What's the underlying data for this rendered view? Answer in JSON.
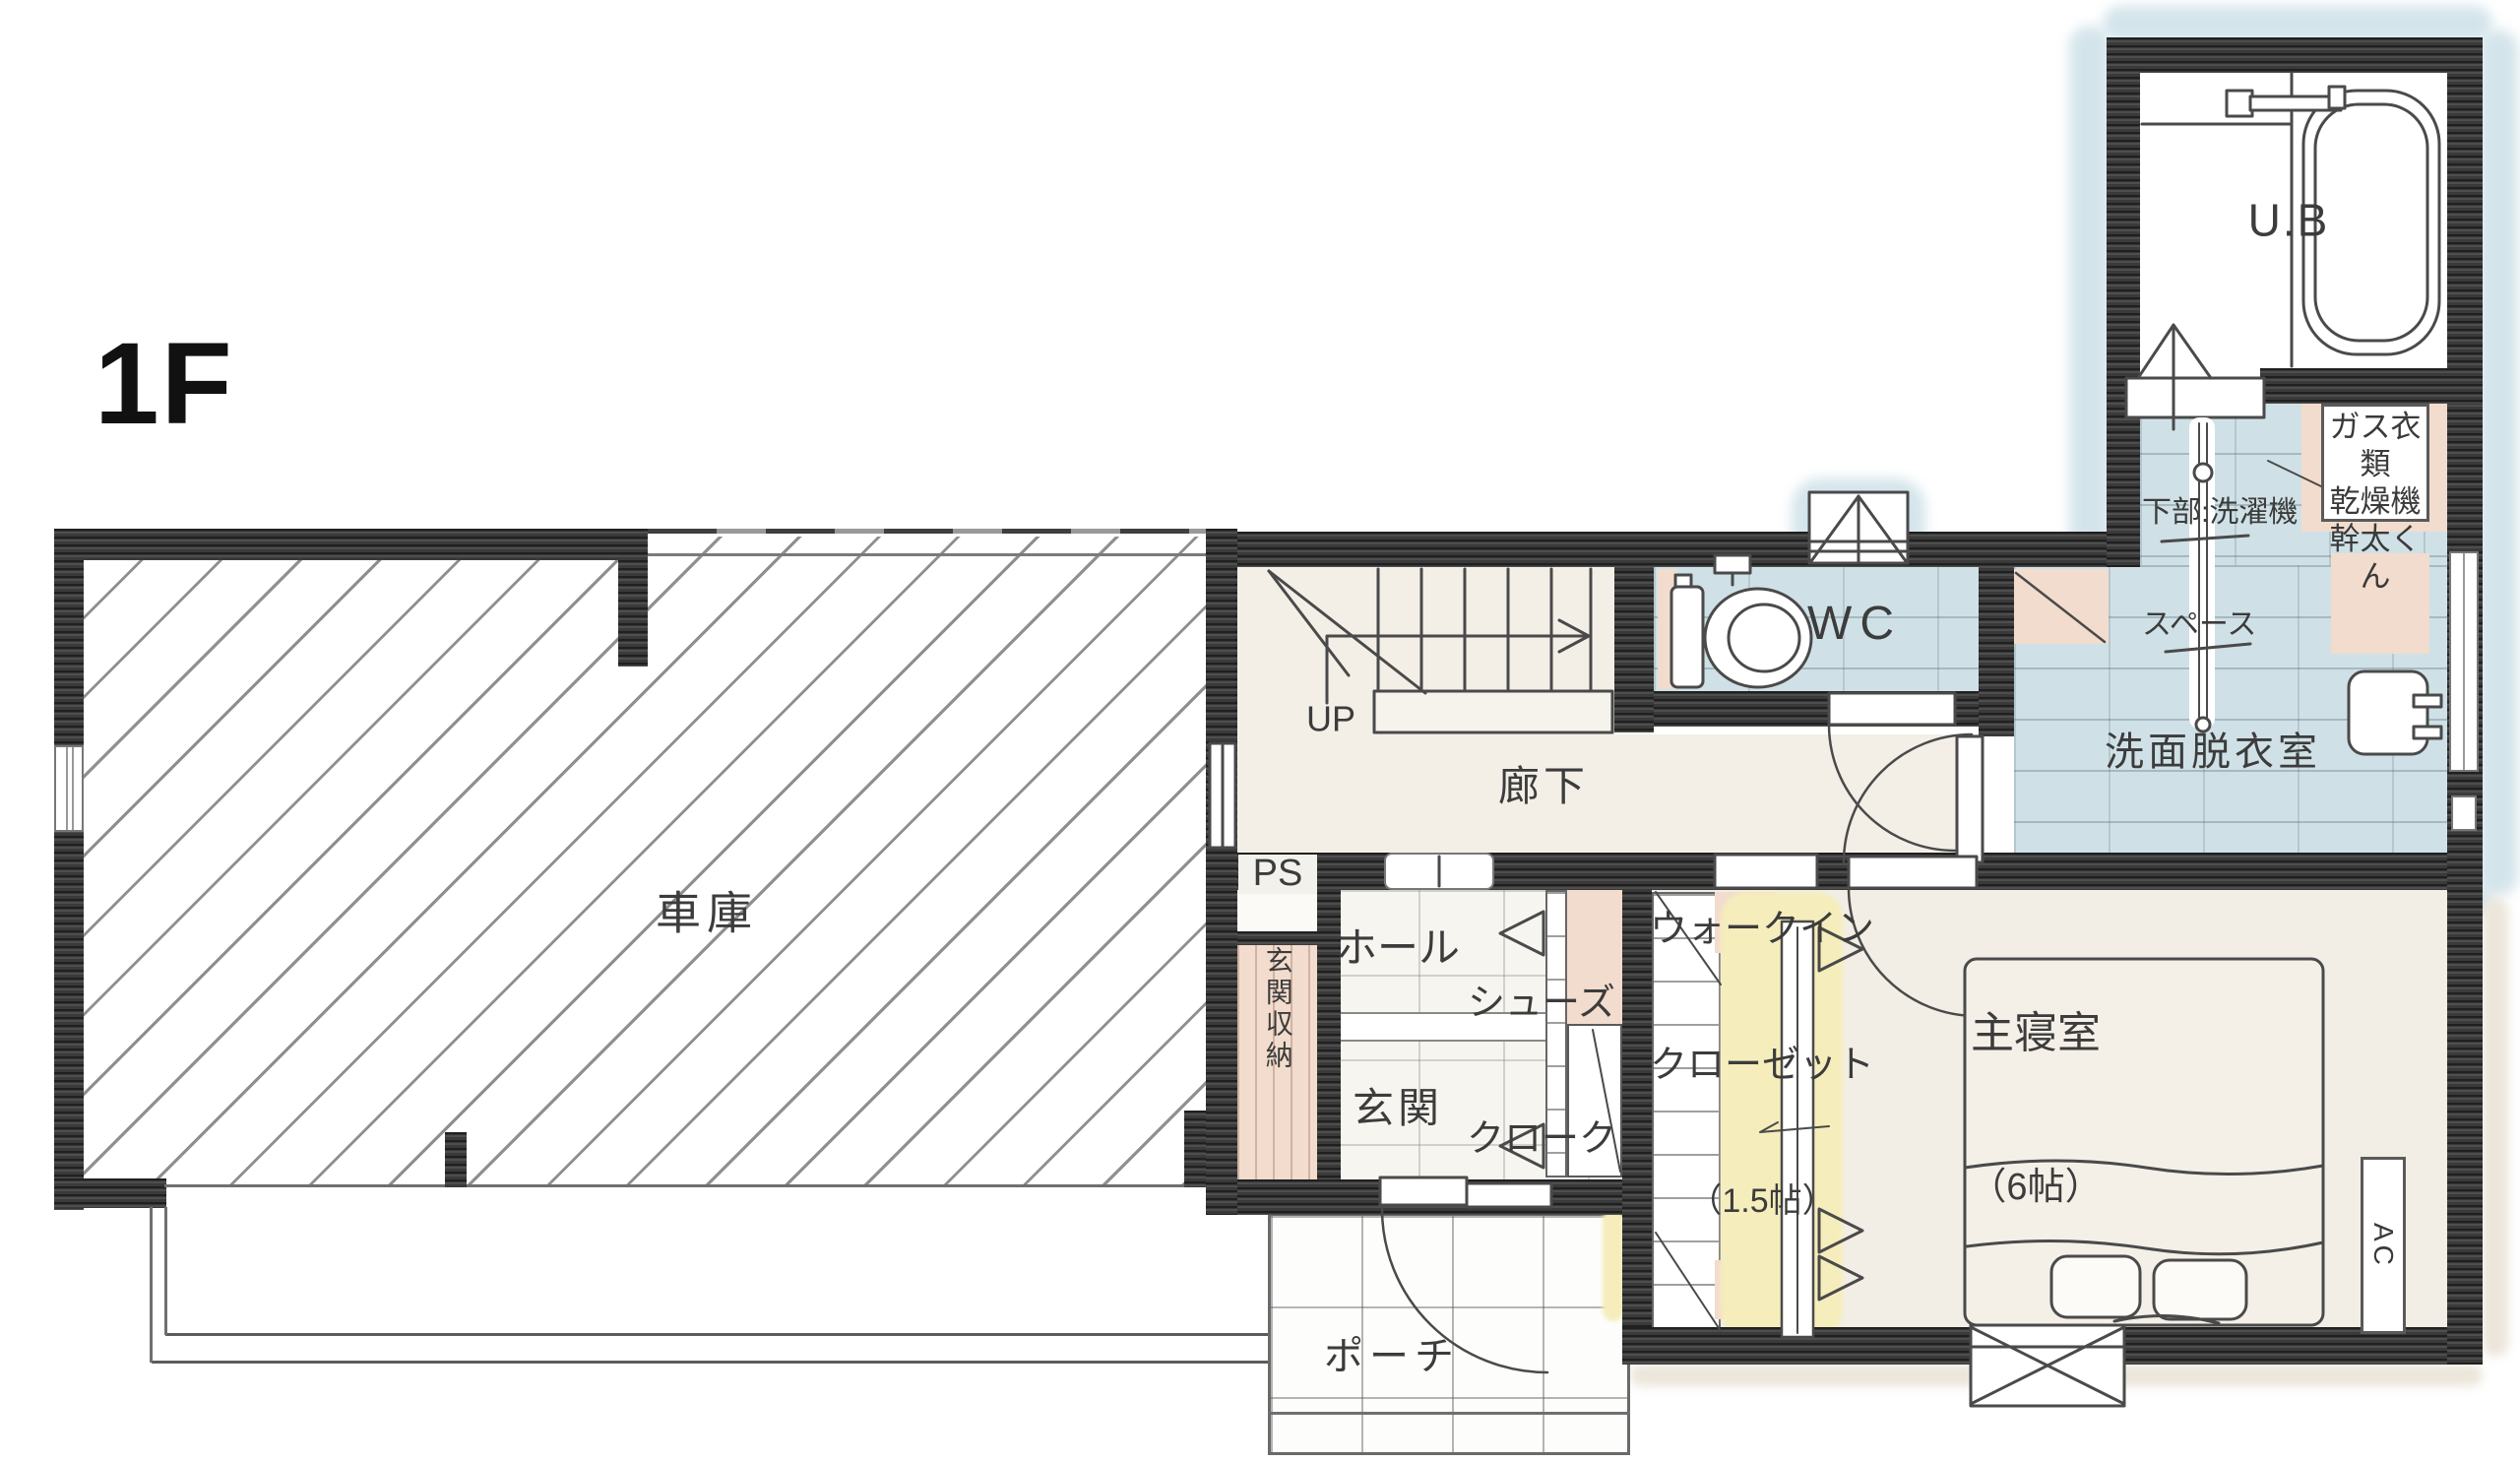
{
  "plan": {
    "floor_label": "1F",
    "type": "floor-plan-hand-drawn",
    "colors": {
      "wall": "#3a3a3a",
      "floor_cream": "#f3efe7",
      "tile_blue": "#cfe1e7",
      "accent_peach": "#f2dccd",
      "accent_yellow": "#f5edbb",
      "watercolor_blue": "#cfe2e9"
    }
  },
  "rooms": {
    "garage": {
      "label": "車庫"
    },
    "porch": {
      "label": "ポーチ"
    },
    "hall": {
      "label": "ホール"
    },
    "entrance": {
      "label": "玄関"
    },
    "entrance_storage": {
      "label": "玄関収納"
    },
    "shoe_closet": {
      "line1": "シューズ",
      "line2": "クローク"
    },
    "walk_in_closet": {
      "line1": "ウォークイン",
      "line2": "クローゼット",
      "size": "（1.5帖）"
    },
    "master_bedroom": {
      "label": "主寝室",
      "size": "（6帖）"
    },
    "corridor": {
      "label": "廊下"
    },
    "wc": {
      "label": "WC"
    },
    "washroom": {
      "label": "洗面脱衣室"
    },
    "bath": {
      "label": "U.B"
    },
    "pipe_space": {
      "label": "PS"
    }
  },
  "annotations": {
    "stairs_up": "UP",
    "ac_unit": "AC",
    "laundry_space_line1": "下部:洗濯機",
    "laundry_space_line2": "スペース",
    "dryer_line1": "ガス衣類",
    "dryer_line2": "乾燥機",
    "dryer_line3": "幹太くん"
  }
}
